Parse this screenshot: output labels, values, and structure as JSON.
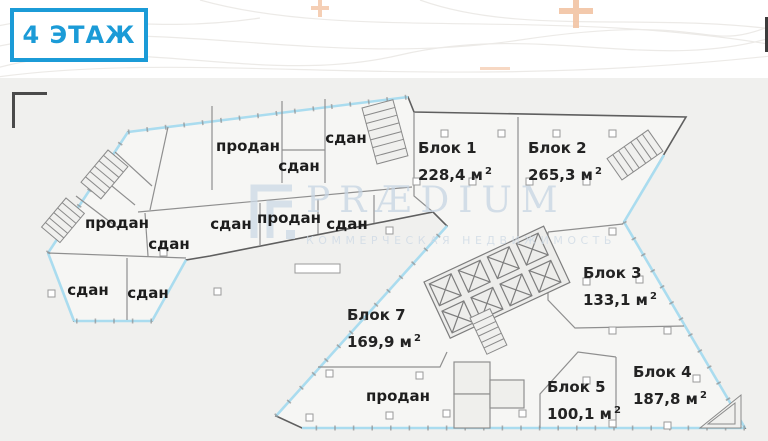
{
  "floor_badge": {
    "label": "4 ЭТАЖ"
  },
  "watermark": {
    "brand": "PRÆDIUM",
    "tagline": "КОММЕРЧЕСКАЯ НЕДВИЖИМОСТЬ"
  },
  "plan": {
    "sup2": "2",
    "blocks": [
      {
        "name": "Блок 1",
        "area": "228,4 м"
      },
      {
        "name": "Блок 2",
        "area": "265,3 м"
      },
      {
        "name": "Блок 3",
        "area": "133,1 м"
      },
      {
        "name": "Блок 4",
        "area": "187,8 м"
      },
      {
        "name": "Блок 5",
        "area": "100,1 м"
      },
      {
        "name": "Блок 7",
        "area": "169,9 м"
      }
    ],
    "status_labels": [
      {
        "text": "продан"
      },
      {
        "text": "сдан"
      },
      {
        "text": "сдан"
      },
      {
        "text": "продан"
      },
      {
        "text": "сдан"
      },
      {
        "text": "сдан"
      },
      {
        "text": "продан"
      },
      {
        "text": "сдан"
      },
      {
        "text": "сдан"
      },
      {
        "text": "сдан"
      },
      {
        "text": "продан"
      }
    ]
  },
  "colors": {
    "accent_blue": "#1b9bd7",
    "window_blue": "#aadcef",
    "watermark_blue": "#c8d6e3",
    "plus_orange": "#f2c3a3",
    "wall_gray": "#6b6b6b"
  }
}
